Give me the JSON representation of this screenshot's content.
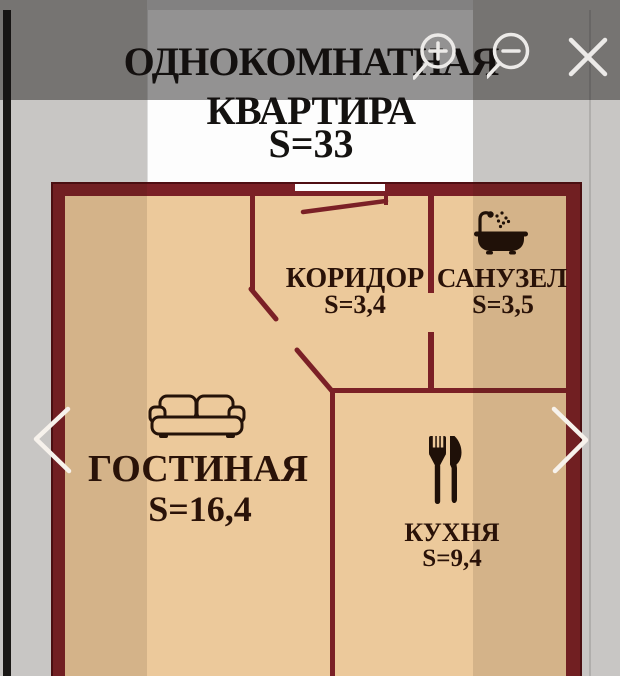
{
  "title": {
    "line1": "ОДНОКОМНАТНАЯ",
    "line2": "КВАРТИРА",
    "line3": "S=33"
  },
  "rooms": [
    {
      "name": "ГОСТИНАЯ",
      "area": "S=16,4",
      "icon": "sofa-icon"
    },
    {
      "name": "КОРИДОР",
      "area": "S=3,4",
      "icon": ""
    },
    {
      "name": "САНУЗЕЛ",
      "area": "S=3,5",
      "icon": "bathtub-shower-icon"
    },
    {
      "name": "КУХНЯ",
      "area": "S=9,4",
      "icon": "fork-knife-icon"
    }
  ],
  "viewer": {
    "toolbar_icons": [
      "zoom-in",
      "zoom-out",
      "close"
    ],
    "nav_icons": [
      "previous-photo",
      "next-photo"
    ]
  },
  "colors": {
    "wall": "#7b2026",
    "wall_outline": "#4f0e13",
    "floor": "#ecc99b",
    "label_text": "#2a1208",
    "title_text": "#141210",
    "page_bg": "#dedede",
    "photo_bg": "#fdfdfd",
    "toolbar_scrim": "rgba(17,15,15,0.45)",
    "control_icon": "#eceae8"
  }
}
